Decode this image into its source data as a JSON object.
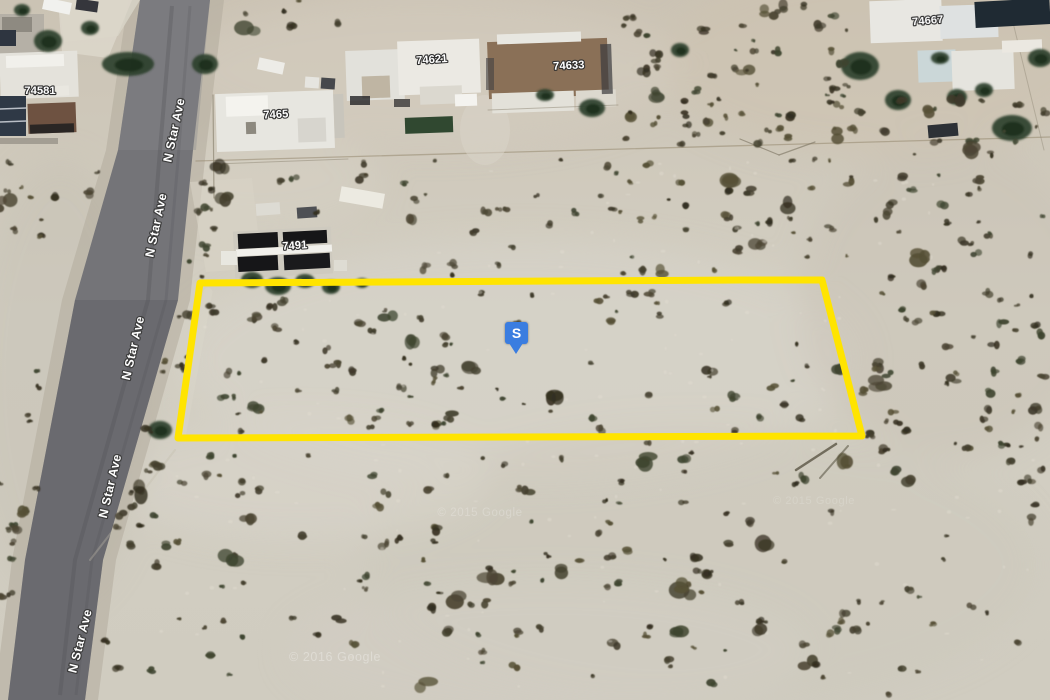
{
  "map": {
    "width": 1050,
    "height": 700,
    "colors": {
      "sand_top": "#cbc3b4",
      "sand_mid": "#d3cfc3",
      "sand_bottom": "#d0ccc0",
      "road_top": "#7b7b7f",
      "road_bottom": "#616165",
      "parcel_stroke": "#FFE400",
      "marker_fill": "#3a7de0",
      "marker_text_color": "#ffffff",
      "label_fill": "#ffffff",
      "label_outline": "#2e2e2e",
      "tree_fill": "#2c3f2a",
      "tree_core": "#1c2e1c",
      "bush_palette": [
        "#4c4634",
        "#3f3a2a",
        "#565036",
        "#45412f",
        "#3f4530",
        "#342f20"
      ],
      "speckle": "#e3ded2"
    },
    "road": {
      "left_edge": [
        [
          0,
          140
        ],
        [
          150,
          118
        ],
        [
          300,
          75
        ],
        [
          560,
          25
        ],
        [
          700,
          8
        ]
      ],
      "right_edge": [
        [
          0,
          210
        ],
        [
          150,
          193
        ],
        [
          300,
          178
        ],
        [
          560,
          103
        ],
        [
          700,
          85
        ]
      ],
      "labels": [
        {
          "text": "N Star Ave",
          "x": 178,
          "y": 131,
          "rot": -78
        },
        {
          "text": "N Star Ave",
          "x": 160,
          "y": 226,
          "rot": -78
        },
        {
          "text": "N Star Ave",
          "x": 137,
          "y": 349,
          "rot": -77
        },
        {
          "text": "N Star Ave",
          "x": 114,
          "y": 487,
          "rot": -77
        },
        {
          "text": "N Star Ave",
          "x": 84,
          "y": 642,
          "rot": -76
        }
      ]
    },
    "address_labels": [
      {
        "text": "74581",
        "x": 40,
        "y": 94,
        "rot": 0
      },
      {
        "text": "7465",
        "x": 276,
        "y": 118,
        "rot": -3
      },
      {
        "text": "74621",
        "x": 432,
        "y": 63,
        "rot": -4
      },
      {
        "text": "74633",
        "x": 569,
        "y": 69,
        "rot": -3
      },
      {
        "text": "74667",
        "x": 928,
        "y": 24,
        "rot": -5
      },
      {
        "text": "7491",
        "x": 295,
        "y": 249,
        "rot": -4
      }
    ],
    "parcel": {
      "points": "200,283 741,280 822,280 862,436 178,438",
      "stroke_width": 7
    },
    "watermarks": [
      {
        "text": "© 2015 Google",
        "x": 480,
        "y": 516,
        "size": 11.5,
        "opacity": 0.22
      },
      {
        "text": "© 2015 Google",
        "x": 814,
        "y": 504,
        "size": 11,
        "opacity": 0.16
      },
      {
        "text": "© 2016 Google",
        "x": 335,
        "y": 661,
        "size": 12.5,
        "opacity": 0.3
      }
    ],
    "patches": [
      {
        "cx": 880,
        "cy": 60,
        "rx": 220,
        "ry": 95,
        "f": "#cdc3b0",
        "o": 0.55
      },
      {
        "cx": 430,
        "cy": 70,
        "rx": 250,
        "ry": 75,
        "f": "#d6cec0",
        "o": 0.5
      },
      {
        "cx": 520,
        "cy": 360,
        "rx": 340,
        "ry": 120,
        "f": "#d7d3c9",
        "o": 0.6
      },
      {
        "cx": 700,
        "cy": 565,
        "rx": 340,
        "ry": 140,
        "f": "#cbc7bb",
        "o": 0.45
      },
      {
        "cx": 950,
        "cy": 300,
        "rx": 150,
        "ry": 160,
        "f": "#c8c2b3",
        "o": 0.45
      },
      {
        "cx": 300,
        "cy": 480,
        "rx": 190,
        "ry": 60,
        "f": "#dad6cb",
        "o": 0.5
      },
      {
        "cx": 60,
        "cy": 380,
        "rx": 90,
        "ry": 220,
        "f": "#c4bfb1",
        "o": 0.4
      },
      {
        "cx": 550,
        "cy": 650,
        "rx": 260,
        "ry": 70,
        "f": "#d2cec3",
        "o": 0.5
      },
      {
        "cx": 260,
        "cy": 180,
        "rx": 120,
        "ry": 50,
        "f": "#d8d2c5",
        "o": 0.5
      }
    ],
    "shapes": [
      {
        "t": "p",
        "pts": "128,0 224,0 206,150 190,300 116,560 98,700 -6,700 12,560 62,300 106,150",
        "f": "#b3ac9c",
        "o": 0.55
      },
      {
        "t": "p",
        "pts": "140,0 210,0 193,150 178,300 103,560 85,700 8,700 25,560 75,300 118,150",
        "f": "#747478"
      },
      {
        "t": "p",
        "pts": "140,0 210,0 196,150 88,150 118,150",
        "f": "#8a8a8c",
        "o": 0.35
      },
      {
        "t": "p",
        "pts": "75,300 178,300 103,560 85,700 8,700 25,560",
        "f": "#5d5d61",
        "o": 0.4
      },
      {
        "t": "pl",
        "pts": "172,6 160,150 148,300 75,560 60,695",
        "s": "#505054",
        "w": 4,
        "o": 0.28
      },
      {
        "t": "pl",
        "pts": "190,6 178,160 166,300 92,560 76,695",
        "s": "#505054",
        "w": 3,
        "o": 0.2
      },
      {
        "t": "p",
        "pts": "58,0 140,0 118,36 64,42",
        "f": "#d7d3c7",
        "o": 0.85
      },
      {
        "t": "l",
        "x1": 196,
        "y1": 161,
        "x2": 1050,
        "y2": 137,
        "s": "#96896f",
        "w": 1.3,
        "o": 0.55
      },
      {
        "t": "l",
        "x1": 740,
        "y1": 139,
        "x2": 779,
        "y2": 155,
        "s": "#7a7260",
        "w": 1.2,
        "o": 0.6
      },
      {
        "t": "l",
        "x1": 779,
        "y1": 155,
        "x2": 815,
        "y2": 142,
        "s": "#7a7260",
        "w": 1.2,
        "o": 0.6
      },
      {
        "t": "l",
        "x1": 1008,
        "y1": 2,
        "x2": 1044,
        "y2": 150,
        "s": "#8a8270",
        "w": 1,
        "o": 0.4
      },
      {
        "t": "l",
        "x1": 208,
        "y1": 292,
        "x2": 182,
        "y2": 432,
        "s": "#dfdbcc",
        "w": 9,
        "o": 0.3
      },
      {
        "t": "l",
        "x1": 175,
        "y1": 450,
        "x2": 90,
        "y2": 560,
        "s": "#c2bcab",
        "w": 2,
        "o": 0.35
      },
      {
        "t": "p",
        "pts": "190,182 252,178 262,268 206,272",
        "f": "#d8d3c6",
        "o": 0.6
      },
      {
        "t": "e",
        "cx": 485,
        "cy": 130,
        "rx": 25,
        "ry": 35,
        "f": "#d9d4c8",
        "o": 0.55
      },
      {
        "t": "r",
        "x": 0,
        "y": 14,
        "w": 44,
        "h": 40,
        "f": "#b5b0a6"
      },
      {
        "t": "r",
        "x": 2,
        "y": 17,
        "w": 30,
        "h": 15,
        "f": "#8e8a81"
      },
      {
        "t": "r",
        "x": 0,
        "y": 30,
        "w": 16,
        "h": 16,
        "f": "#2e3540"
      },
      {
        "t": "p",
        "pts": "58,0 132,0 108,58 62,52",
        "f": "#dbd6ca",
        "o": 0.9
      },
      {
        "t": "r",
        "x": 43,
        "y": 0,
        "w": 28,
        "h": 12,
        "f": "#f1f1ee",
        "rot": 12
      },
      {
        "t": "r",
        "x": 76,
        "y": 0,
        "w": 22,
        "h": 11,
        "f": "#35363c",
        "rot": 8
      },
      {
        "t": "r",
        "x": 0,
        "y": 52,
        "w": 78,
        "h": 46,
        "f": "#e4e2db",
        "rot": -2
      },
      {
        "t": "r",
        "x": 6,
        "y": 55,
        "w": 58,
        "h": 12,
        "f": "#f1f0eb",
        "rot": -2
      },
      {
        "t": "r",
        "x": 47,
        "y": 86,
        "w": 22,
        "h": 10,
        "f": "#e9e7e0",
        "rot": -3
      },
      {
        "t": "r",
        "x": 0,
        "y": 96,
        "w": 26,
        "h": 40,
        "f": "#2f3946"
      },
      {
        "t": "l",
        "x1": 0,
        "y1": 109,
        "x2": 26,
        "y2": 108,
        "s": "#c8cdd4",
        "w": 1.5,
        "o": 0.9
      },
      {
        "t": "l",
        "x1": 0,
        "y1": 122,
        "x2": 26,
        "y2": 121,
        "s": "#c8cdd4",
        "w": 1.5,
        "o": 0.9
      },
      {
        "t": "r",
        "x": 28,
        "y": 103,
        "w": 48,
        "h": 30,
        "f": "#6e5241",
        "rot": -2
      },
      {
        "t": "r",
        "x": 30,
        "y": 124,
        "w": 44,
        "h": 9,
        "f": "#1e1e20",
        "rot": -2,
        "o": 0.85
      },
      {
        "t": "r",
        "x": 0,
        "y": 138,
        "w": 58,
        "h": 6,
        "f": "#99938a",
        "o": 0.8
      },
      {
        "t": "r",
        "x": 258,
        "y": 60,
        "w": 26,
        "h": 12,
        "f": "#edece7",
        "rot": 12
      },
      {
        "t": "r",
        "x": 305,
        "y": 77,
        "w": 14,
        "h": 11,
        "f": "#e6e5e0",
        "rot": 4
      },
      {
        "t": "r",
        "x": 321,
        "y": 78,
        "w": 14,
        "h": 11,
        "f": "#46484c",
        "rot": 4
      },
      {
        "t": "r",
        "x": 216,
        "y": 92,
        "w": 118,
        "h": 58,
        "f": "#e7e6e0",
        "rot": -2
      },
      {
        "t": "r",
        "x": 226,
        "y": 96,
        "w": 42,
        "h": 20,
        "f": "#f4f3ee",
        "rot": -2
      },
      {
        "t": "r",
        "x": 298,
        "y": 118,
        "w": 28,
        "h": 24,
        "f": "#d7d5ce",
        "rot": -2
      },
      {
        "t": "r",
        "x": 246,
        "y": 122,
        "w": 10,
        "h": 12,
        "f": "#8d897f",
        "rot": -2
      },
      {
        "t": "r",
        "x": 334,
        "y": 94,
        "w": 10,
        "h": 44,
        "f": "#c8c5bc",
        "rot": -2
      },
      {
        "t": "l",
        "x1": 213,
        "y1": 95,
        "x2": 214,
        "y2": 198,
        "s": "#8e8674",
        "w": 1.2,
        "o": 0.7
      },
      {
        "t": "l",
        "x1": 216,
        "y1": 164,
        "x2": 348,
        "y2": 159,
        "s": "#8e8674",
        "w": 1,
        "o": 0.5
      },
      {
        "t": "r",
        "x": 346,
        "y": 50,
        "w": 58,
        "h": 50,
        "f": "#e2e1db",
        "rot": -2
      },
      {
        "t": "r",
        "x": 398,
        "y": 40,
        "w": 82,
        "h": 54,
        "f": "#ebe9e3",
        "rot": -2
      },
      {
        "t": "r",
        "x": 362,
        "y": 76,
        "w": 28,
        "h": 22,
        "f": "#bfb5a3",
        "rot": -2
      },
      {
        "t": "r",
        "x": 420,
        "y": 86,
        "w": 42,
        "h": 18,
        "f": "#dbd8cf",
        "rot": -2
      },
      {
        "t": "r",
        "x": 350,
        "y": 96,
        "w": 20,
        "h": 9,
        "f": "#232325",
        "o": 0.8
      },
      {
        "t": "r",
        "x": 394,
        "y": 99,
        "w": 16,
        "h": 8,
        "f": "#232325",
        "o": 0.7
      },
      {
        "t": "r",
        "x": 405,
        "y": 117,
        "w": 48,
        "h": 16,
        "f": "#304830",
        "rot": -2
      },
      {
        "t": "r",
        "x": 455,
        "y": 94,
        "w": 22,
        "h": 12,
        "f": "#f4f3ef",
        "rot": -2
      },
      {
        "t": "r",
        "x": 488,
        "y": 40,
        "w": 120,
        "h": 57,
        "f": "#8a7057",
        "rot": -2
      },
      {
        "t": "r",
        "x": 497,
        "y": 33,
        "w": 84,
        "h": 10,
        "f": "#e8e7e1",
        "rot": -2
      },
      {
        "t": "r",
        "x": 492,
        "y": 92,
        "w": 82,
        "h": 20,
        "f": "#e3e1d9",
        "rot": -2
      },
      {
        "t": "r",
        "x": 576,
        "y": 90,
        "w": 40,
        "h": 17,
        "f": "#dcd8ce",
        "rot": -2
      },
      {
        "t": "r",
        "x": 601,
        "y": 44,
        "w": 11,
        "h": 50,
        "f": "#3b3b3d",
        "rot": -2,
        "o": 0.7
      },
      {
        "t": "r",
        "x": 486,
        "y": 58,
        "w": 8,
        "h": 32,
        "f": "#413f41",
        "o": 0.6
      },
      {
        "t": "l",
        "x1": 488,
        "y1": 110,
        "x2": 618,
        "y2": 105,
        "s": "#8e8674",
        "w": 1,
        "o": 0.5
      },
      {
        "t": "r",
        "x": 870,
        "y": 0,
        "w": 72,
        "h": 42,
        "f": "#e8e7e2",
        "rot": -2
      },
      {
        "t": "r",
        "x": 940,
        "y": 5,
        "w": 58,
        "h": 33,
        "f": "#dee1e1",
        "rot": -2
      },
      {
        "t": "r",
        "x": 918,
        "y": 50,
        "w": 38,
        "h": 32,
        "f": "#cbd7d8",
        "rot": -2
      },
      {
        "t": "r",
        "x": 952,
        "y": 50,
        "w": 62,
        "h": 40,
        "f": "#e5e4de",
        "rot": -2
      },
      {
        "t": "r",
        "x": 975,
        "y": 0,
        "w": 75,
        "h": 26,
        "f": "#1f2a33",
        "rot": -3
      },
      {
        "t": "r",
        "x": 1002,
        "y": 40,
        "w": 40,
        "h": 12,
        "f": "#ebe8e1",
        "rot": -2
      },
      {
        "t": "r",
        "x": 928,
        "y": 124,
        "w": 30,
        "h": 13,
        "f": "#2d3136",
        "rot": -5
      },
      {
        "t": "r",
        "x": 340,
        "y": 190,
        "w": 44,
        "h": 15,
        "f": "#ecea e1",
        "rot": 10
      },
      {
        "t": "r",
        "x": 256,
        "y": 203,
        "w": 24,
        "h": 12,
        "f": "#dddbd3",
        "rot": -4
      },
      {
        "t": "r",
        "x": 297,
        "y": 207,
        "w": 20,
        "h": 11,
        "f": "#4e5054",
        "rot": -4
      },
      {
        "t": "r",
        "x": 234,
        "y": 229,
        "w": 98,
        "h": 47,
        "f": "#cecabf",
        "rot": -3
      },
      {
        "t": "r",
        "x": 238,
        "y": 233,
        "w": 40,
        "h": 15,
        "f": "#161618",
        "rot": -3
      },
      {
        "t": "r",
        "x": 283,
        "y": 231,
        "w": 44,
        "h": 13,
        "f": "#161618",
        "rot": -3
      },
      {
        "t": "r",
        "x": 238,
        "y": 256,
        "w": 40,
        "h": 15,
        "f": "#161618",
        "rot": -3
      },
      {
        "t": "r",
        "x": 284,
        "y": 254,
        "w": 46,
        "h": 15,
        "f": "#1a1a1c",
        "rot": -3
      },
      {
        "t": "r",
        "x": 236,
        "y": 247,
        "w": 96,
        "h": 7,
        "f": "#f1f0eb",
        "rot": -3
      },
      {
        "t": "r",
        "x": 221,
        "y": 251,
        "w": 16,
        "h": 14,
        "f": "#e8e7e0"
      },
      {
        "t": "r",
        "x": 334,
        "y": 260,
        "w": 13,
        "h": 11,
        "f": "#dedcd3"
      },
      {
        "t": "l",
        "x1": 836,
        "y1": 444,
        "x2": 796,
        "y2": 470,
        "s": "#4b4534",
        "w": 2.5,
        "o": 0.7
      },
      {
        "t": "l",
        "x1": 848,
        "y1": 446,
        "x2": 820,
        "y2": 478,
        "s": "#55503e",
        "w": 2,
        "o": 0.55
      }
    ],
    "trees": [
      {
        "x": 48,
        "y": 41,
        "rx": 14,
        "ry": 11
      },
      {
        "x": 90,
        "y": 28,
        "rx": 9,
        "ry": 7
      },
      {
        "x": 22,
        "y": 10,
        "rx": 8,
        "ry": 6
      },
      {
        "x": 128,
        "y": 64,
        "rx": 26,
        "ry": 12
      },
      {
        "x": 205,
        "y": 64,
        "rx": 13,
        "ry": 10
      },
      {
        "x": 545,
        "y": 95,
        "rx": 9,
        "ry": 6
      },
      {
        "x": 592,
        "y": 108,
        "rx": 13,
        "ry": 9
      },
      {
        "x": 680,
        "y": 50,
        "rx": 9,
        "ry": 7
      },
      {
        "x": 860,
        "y": 66,
        "rx": 19,
        "ry": 14
      },
      {
        "x": 898,
        "y": 100,
        "rx": 13,
        "ry": 10
      },
      {
        "x": 940,
        "y": 58,
        "rx": 9,
        "ry": 6
      },
      {
        "x": 957,
        "y": 97,
        "rx": 10,
        "ry": 8
      },
      {
        "x": 984,
        "y": 90,
        "rx": 9,
        "ry": 7
      },
      {
        "x": 1012,
        "y": 128,
        "rx": 20,
        "ry": 13
      },
      {
        "x": 1040,
        "y": 58,
        "rx": 12,
        "ry": 9
      },
      {
        "x": 252,
        "y": 280,
        "rx": 11,
        "ry": 8
      },
      {
        "x": 278,
        "y": 286,
        "rx": 13,
        "ry": 9
      },
      {
        "x": 305,
        "y": 281,
        "rx": 10,
        "ry": 7
      },
      {
        "x": 331,
        "y": 287,
        "rx": 9,
        "ry": 7
      },
      {
        "x": 362,
        "y": 283,
        "rx": 7,
        "ry": 5
      },
      {
        "x": 160,
        "y": 430,
        "rx": 12,
        "ry": 9
      }
    ],
    "vegetation_regions": [
      {
        "x": 622,
        "y": 5,
        "w": 235,
        "h": 130,
        "c": 48
      },
      {
        "x": 858,
        "y": 96,
        "w": 190,
        "h": 48,
        "c": 16
      },
      {
        "x": 400,
        "y": 158,
        "w": 455,
        "h": 118,
        "c": 60
      },
      {
        "x": 198,
        "y": 162,
        "w": 200,
        "h": 55,
        "c": 10
      },
      {
        "x": 612,
        "y": 100,
        "w": 245,
        "h": 45,
        "c": 18
      },
      {
        "x": 860,
        "y": 148,
        "w": 188,
        "h": 305,
        "c": 80
      },
      {
        "x": 210,
        "y": 292,
        "w": 640,
        "h": 140,
        "c": 55
      },
      {
        "x": 216,
        "y": 300,
        "w": 270,
        "h": 132,
        "c": 30
      },
      {
        "x": 150,
        "y": 443,
        "w": 898,
        "h": 252,
        "c": 160
      },
      {
        "x": 0,
        "y": 150,
        "w": 55,
        "h": 110,
        "c": 10
      },
      {
        "x": 0,
        "y": 300,
        "w": 40,
        "h": 250,
        "c": 8
      },
      {
        "x": 240,
        "y": 0,
        "w": 100,
        "h": 35,
        "c": 6
      }
    ],
    "speckle_regions": [
      {
        "x": 160,
        "y": 440,
        "w": 880,
        "h": 250,
        "c": 70
      },
      {
        "x": 205,
        "y": 286,
        "w": 640,
        "h": 145,
        "c": 45
      },
      {
        "x": 400,
        "y": 160,
        "w": 600,
        "h": 110,
        "c": 30
      }
    ],
    "roadside_vegetation": {
      "east": 30,
      "west": 9
    }
  },
  "marker": {
    "label": "S",
    "x": 505,
    "y": 322
  }
}
